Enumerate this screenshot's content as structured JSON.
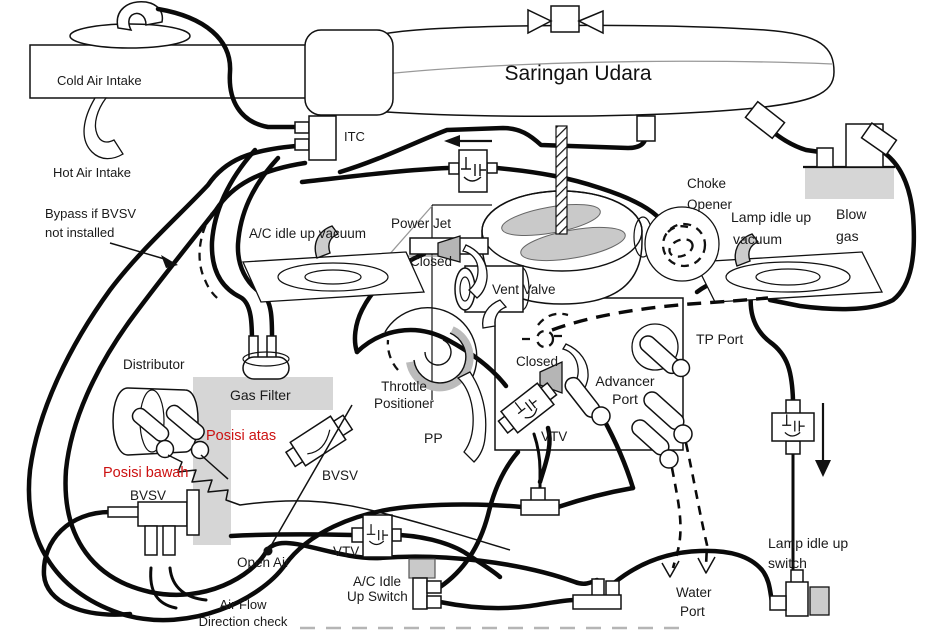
{
  "labels": {
    "cold_air_intake": "Cold Air Intake",
    "hot_air_intake": "Hot Air Intake",
    "saringan_udara": "Saringan Udara",
    "itc": "ITC",
    "choke_opener_1": "Choke",
    "choke_opener_2": "Opener",
    "lamp_idle_vacuum_1": "Lamp idle up",
    "lamp_idle_vacuum_2": "vacuum",
    "blow_gas_1": "Blow",
    "blow_gas_2": "gas",
    "bypass_1": "Bypass if BVSV",
    "bypass_2": "not installed",
    "ac_idle_up_vacuum": "A/C idle up vacuum",
    "power_jet": "Power Jet",
    "closed_top": "Closed",
    "vent_valve": "Vent Valve",
    "closed_mid": "Closed",
    "tp_port": "TP Port",
    "advancer_port_1": "Advancer",
    "advancer_port_2": "Port",
    "distributor": "Distributor",
    "gas_filter": "Gas Filter",
    "posisi_atas": "Posisi atas",
    "posisi_bawah": "Posisi bawah",
    "bvsv_diagonal": "BVSV",
    "bvsv_left": "BVSV",
    "throttle_positioner_1": "Throttle",
    "throttle_positioner_2": "Positioner",
    "pp": "PP",
    "vtv_center": "VTV",
    "vtv_left": "VTV",
    "open_air": "Open Air",
    "air_flow_1": "Air Flow",
    "air_flow_2": "Direction check",
    "ac_idle_switch_1": "A/C Idle",
    "ac_idle_switch_2": "Up Switch",
    "water_port_1": "Water",
    "water_port_2": "Port",
    "lamp_idle_switch_1": "Lamp idle up",
    "lamp_idle_switch_2": "switch"
  },
  "colors": {
    "red_label": "#cc1111",
    "gray_fill": "#d6d6d6",
    "line": "#111111"
  }
}
